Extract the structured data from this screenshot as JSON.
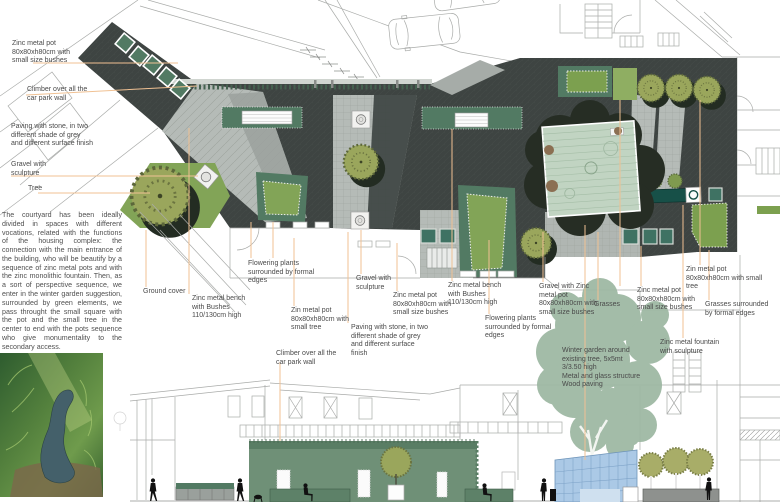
{
  "document": {
    "kind": "courtyard landscape design plan with annotations, section and photo",
    "colors": {
      "leader_line_orange": "#f0c193",
      "charcoal_paving": "#3e4442",
      "light_paving_grey": "#b5bbb7",
      "mid_paving_grey": "#9ba19d",
      "hedge_sage_green": "#527a63",
      "lawn_bright_green": "#82a457",
      "olive_tree_green": "#9aa65c",
      "winter_garden_pale": "#c1d4c2",
      "fountain_teal": "#175048",
      "glass_structure_blue": "#abc9e6",
      "existing_tree_canopy": "#9db7a2",
      "silhouette_black": "#111111"
    }
  },
  "paragraph": "The courtyard has been ideally divided in spaces with different vocations, related with the functions of the housing complex: the connection with the main entrance of the building, who will be beautify by a sequence of zinc metal pots and with the zinc monolithic fountain. Then, as a sort of perspective sequence, we enter in the winter garden suggestion, surrounded by green elements, we pass throught the small square with the pot and the small tree in the center to end with the pots sequence who give monumentality to the secondary access.",
  "labels": [
    {
      "id": "zinc-pot-top-left",
      "text": "Zinc metal pot 80x80xh80cm with small size bushes"
    },
    {
      "id": "climber-top-left",
      "text": "Climber over all the car park wall"
    },
    {
      "id": "paving-top-left",
      "text": "Paving with stone, in two different shade of grey and different surface finish"
    },
    {
      "id": "gravel-top-left",
      "text": "Gravel with sculpture"
    },
    {
      "id": "tree-top-left",
      "text": "Tree"
    },
    {
      "id": "ground-cover",
      "text": "Ground cover"
    },
    {
      "id": "bench-1",
      "text": "Zinc metal bench with Bushes 110/130cm high"
    },
    {
      "id": "flowering-1",
      "text": "Flowering plants surrounded by formal edges"
    },
    {
      "id": "zin-pot-small-tree-1",
      "text": "Zin metal pot 80x80xh80cm with small tree"
    },
    {
      "id": "climber-2",
      "text": "Climber over all the car park wall"
    },
    {
      "id": "gravel-2",
      "text": "Gravel with sculpture"
    },
    {
      "id": "zinc-pot-2",
      "text": "Zinc metal pot 80x80xh80cm with small size bushes"
    },
    {
      "id": "bench-2",
      "text": "Zinc metal bench with Bushes 110/130cm high"
    },
    {
      "id": "paving-2",
      "text": "Paving with stone, in two different shade of grey and different surface finish"
    },
    {
      "id": "flowering-2",
      "text": "Flowering plants surrounded by formal edges"
    },
    {
      "id": "gravel-pot-3",
      "text": "Gravel with Zinc metal pot 80x80xh80cm with small size bushes"
    },
    {
      "id": "grasses-1",
      "text": "Grasses"
    },
    {
      "id": "zinc-pot-4",
      "text": "Zinc metal pot 80x80xh80cm with small size bushes"
    },
    {
      "id": "zin-pot-small-tree-2",
      "text": "Zin metal pot 80x80xh80cm with small tree"
    },
    {
      "id": "grasses-2",
      "text": "Grasses surrounded by formal edges"
    },
    {
      "id": "fountain",
      "text": "Zinc metal fountain with sculpture"
    },
    {
      "id": "winter-garden",
      "text": "Winter garden around\nexisting tree, 5x5mt\n3/3.50 high\nMetal and glass structure\nWood paving"
    }
  ]
}
